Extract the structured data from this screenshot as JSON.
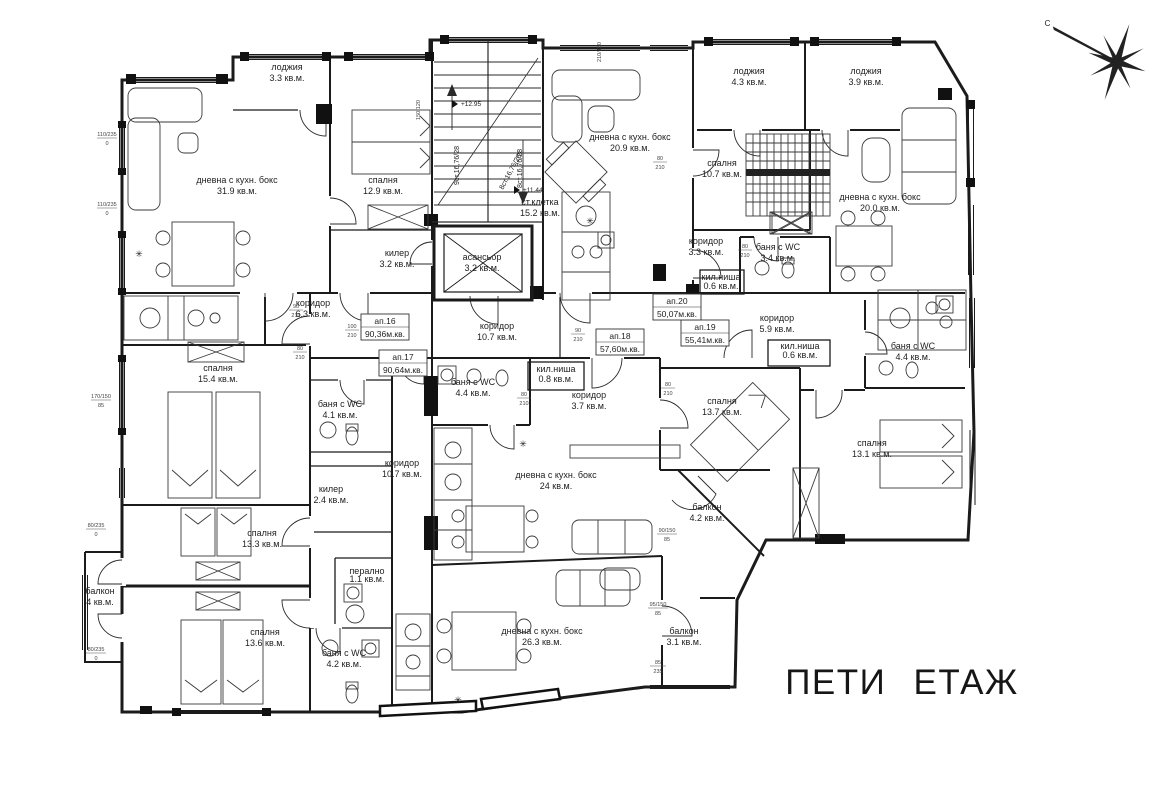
{
  "title": "ПЕТИ ЕТАЖ",
  "compass": {
    "label": "С"
  },
  "symbols": {
    "star": "✳"
  },
  "rooms": [
    {
      "name": "лоджия",
      "area": "3.3 кв.м.",
      "x": 287,
      "y": 70
    },
    {
      "name": "дневна с кухн. бокс",
      "area": "31.9 кв.м.",
      "x": 237,
      "y": 183
    },
    {
      "name": "спалня",
      "area": "12.9 кв.м.",
      "x": 383,
      "y": 183
    },
    {
      "name": "килер",
      "area": "3.2 кв.м.",
      "x": 397,
      "y": 256
    },
    {
      "name": "ст.клетка",
      "area": "15.2 кв.м.",
      "x": 540,
      "y": 205
    },
    {
      "name": "асансьор",
      "area": "3.2 кв.м.",
      "x": 482,
      "y": 260
    },
    {
      "name": "дневна с кухн. бокс",
      "area": "20.9 кв.м.",
      "x": 630,
      "y": 140
    },
    {
      "name": "лоджия",
      "area": "4.3 кв.м.",
      "x": 749,
      "y": 74
    },
    {
      "name": "лоджия",
      "area": "3.9 кв.м.",
      "x": 866,
      "y": 74
    },
    {
      "name": "спалня",
      "area": "10.7 кв.м.",
      "x": 722,
      "y": 166
    },
    {
      "name": "дневна с кухн. бокс",
      "area": "20.0 кв.м.",
      "x": 880,
      "y": 200
    },
    {
      "name": "коридор",
      "area": "3.3 кв.м.",
      "x": 706,
      "y": 244
    },
    {
      "name": "баня с WC",
      "area": "3.4 кв.м.",
      "x": 778,
      "y": 250
    },
    {
      "name": "кил.ниша",
      "area": "0.6 кв.м.",
      "x": 721,
      "y": 280
    },
    {
      "name": "коридор",
      "area": "5.9 кв.м.",
      "x": 777,
      "y": 321
    },
    {
      "name": "кил.ниша",
      "area": "0.6 кв.м.",
      "x": 800,
      "y": 347
    },
    {
      "name": "коридор",
      "area": "6.3 кв.м.",
      "x": 313,
      "y": 306
    },
    {
      "name": "спалня",
      "area": "15.4 кв.м.",
      "x": 218,
      "y": 371
    },
    {
      "name": "баня с WC",
      "area": "4.1 кв.м.",
      "x": 340,
      "y": 407
    },
    {
      "name": "коридор",
      "area": "10.7 кв.м.",
      "x": 497,
      "y": 329
    },
    {
      "name": "баня с WC",
      "area": "4.4 кв.м.",
      "x": 473,
      "y": 385
    },
    {
      "name": "кил.ниша",
      "area": "0.8 кв.м.",
      "x": 556,
      "y": 372
    },
    {
      "name": "коридор",
      "area": "3.7 кв.м.",
      "x": 589,
      "y": 398
    },
    {
      "name": "спалня",
      "area": "13.7 кв.м.",
      "x": 722,
      "y": 404
    },
    {
      "name": "баня с WC",
      "area": "4.4 кв.м.",
      "x": 913,
      "y": 349
    },
    {
      "name": "спалня",
      "area": "13.1 кв.м.",
      "x": 872,
      "y": 446
    },
    {
      "name": "коридор",
      "area": "10.7 кв.м.",
      "x": 402,
      "y": 466
    },
    {
      "name": "килер",
      "area": "2.4 кв.м.",
      "x": 331,
      "y": 492
    },
    {
      "name": "дневна с кухн. бокс",
      "area": "24 кв.м.",
      "x": 556,
      "y": 478
    },
    {
      "name": "балкон",
      "area": "4.2 кв.м.",
      "x": 707,
      "y": 510
    },
    {
      "name": "спалня",
      "area": "13.3 кв.м.",
      "x": 262,
      "y": 536
    },
    {
      "name": "балкон",
      "area": "4 кв.м.",
      "x": 100,
      "y": 594
    },
    {
      "name": "перално",
      "area": "1.1 кв.м.",
      "x": 367,
      "y": 574
    },
    {
      "name": "спалня",
      "area": "13.6 кв.м.",
      "x": 265,
      "y": 635
    },
    {
      "name": "баня с WC",
      "area": "4.2 кв.м.",
      "x": 344,
      "y": 656
    },
    {
      "name": "дневна с кухн. бокс",
      "area": "26.3 кв.м.",
      "x": 542,
      "y": 634
    },
    {
      "name": "балкон",
      "area": "3.1 кв.м.",
      "x": 684,
      "y": 634
    }
  ],
  "apartments": [
    {
      "id": "ап.16",
      "area": "90,36м.кв.",
      "x": 385,
      "y": 322
    },
    {
      "id": "ап.17",
      "area": "90,64м.кв.",
      "x": 403,
      "y": 358
    },
    {
      "id": "ап.18",
      "area": "57,60м.кв.",
      "x": 620,
      "y": 337
    },
    {
      "id": "ап.19",
      "area": "55,41м.кв.",
      "x": 705,
      "y": 328
    },
    {
      "id": "ап.20",
      "area": "50,07м.кв.",
      "x": 677,
      "y": 302
    }
  ],
  "stairs": {
    "flight_a": "9ст.16,76/28",
    "flight_b": "8ст.16,76/28",
    "flight_c": "8ст.16,76/28",
    "level_top": "+12.95",
    "level_mid": "+11.44"
  },
  "dims": [
    {
      "a": "110/235",
      "b": "0",
      "x": 107,
      "y": 136
    },
    {
      "a": "110/235",
      "b": "0",
      "x": 107,
      "y": 206
    },
    {
      "a": "170/150",
      "b": "85",
      "x": 101,
      "y": 398
    },
    {
      "a": "80/235",
      "b": "0",
      "x": 96,
      "y": 527
    },
    {
      "a": "80/235",
      "b": "0",
      "x": 96,
      "y": 651
    },
    {
      "a": "90/150",
      "b": "85",
      "x": 667,
      "y": 532
    },
    {
      "a": "95/150",
      "b": "85",
      "x": 658,
      "y": 606
    },
    {
      "a": "85",
      "b": "235",
      "x": 658,
      "y": 664
    }
  ],
  "vdims": [
    {
      "t": "150/120",
      "x": 420,
      "y": 110
    },
    {
      "t": "210/150",
      "x": 601,
      "y": 52
    }
  ],
  "ddims": [
    {
      "a": "90",
      "b": "210",
      "x": 296,
      "y": 308
    },
    {
      "a": "80",
      "b": "210",
      "x": 300,
      "y": 350
    },
    {
      "a": "100",
      "b": "210",
      "x": 352,
      "y": 328
    },
    {
      "a": "80",
      "b": "210",
      "x": 524,
      "y": 396
    },
    {
      "a": "80",
      "b": "210",
      "x": 668,
      "y": 386
    },
    {
      "a": "80",
      "b": "210",
      "x": 745,
      "y": 248
    },
    {
      "a": "90",
      "b": "210",
      "x": 578,
      "y": 332
    },
    {
      "a": "80",
      "b": "210",
      "x": 660,
      "y": 160
    }
  ]
}
